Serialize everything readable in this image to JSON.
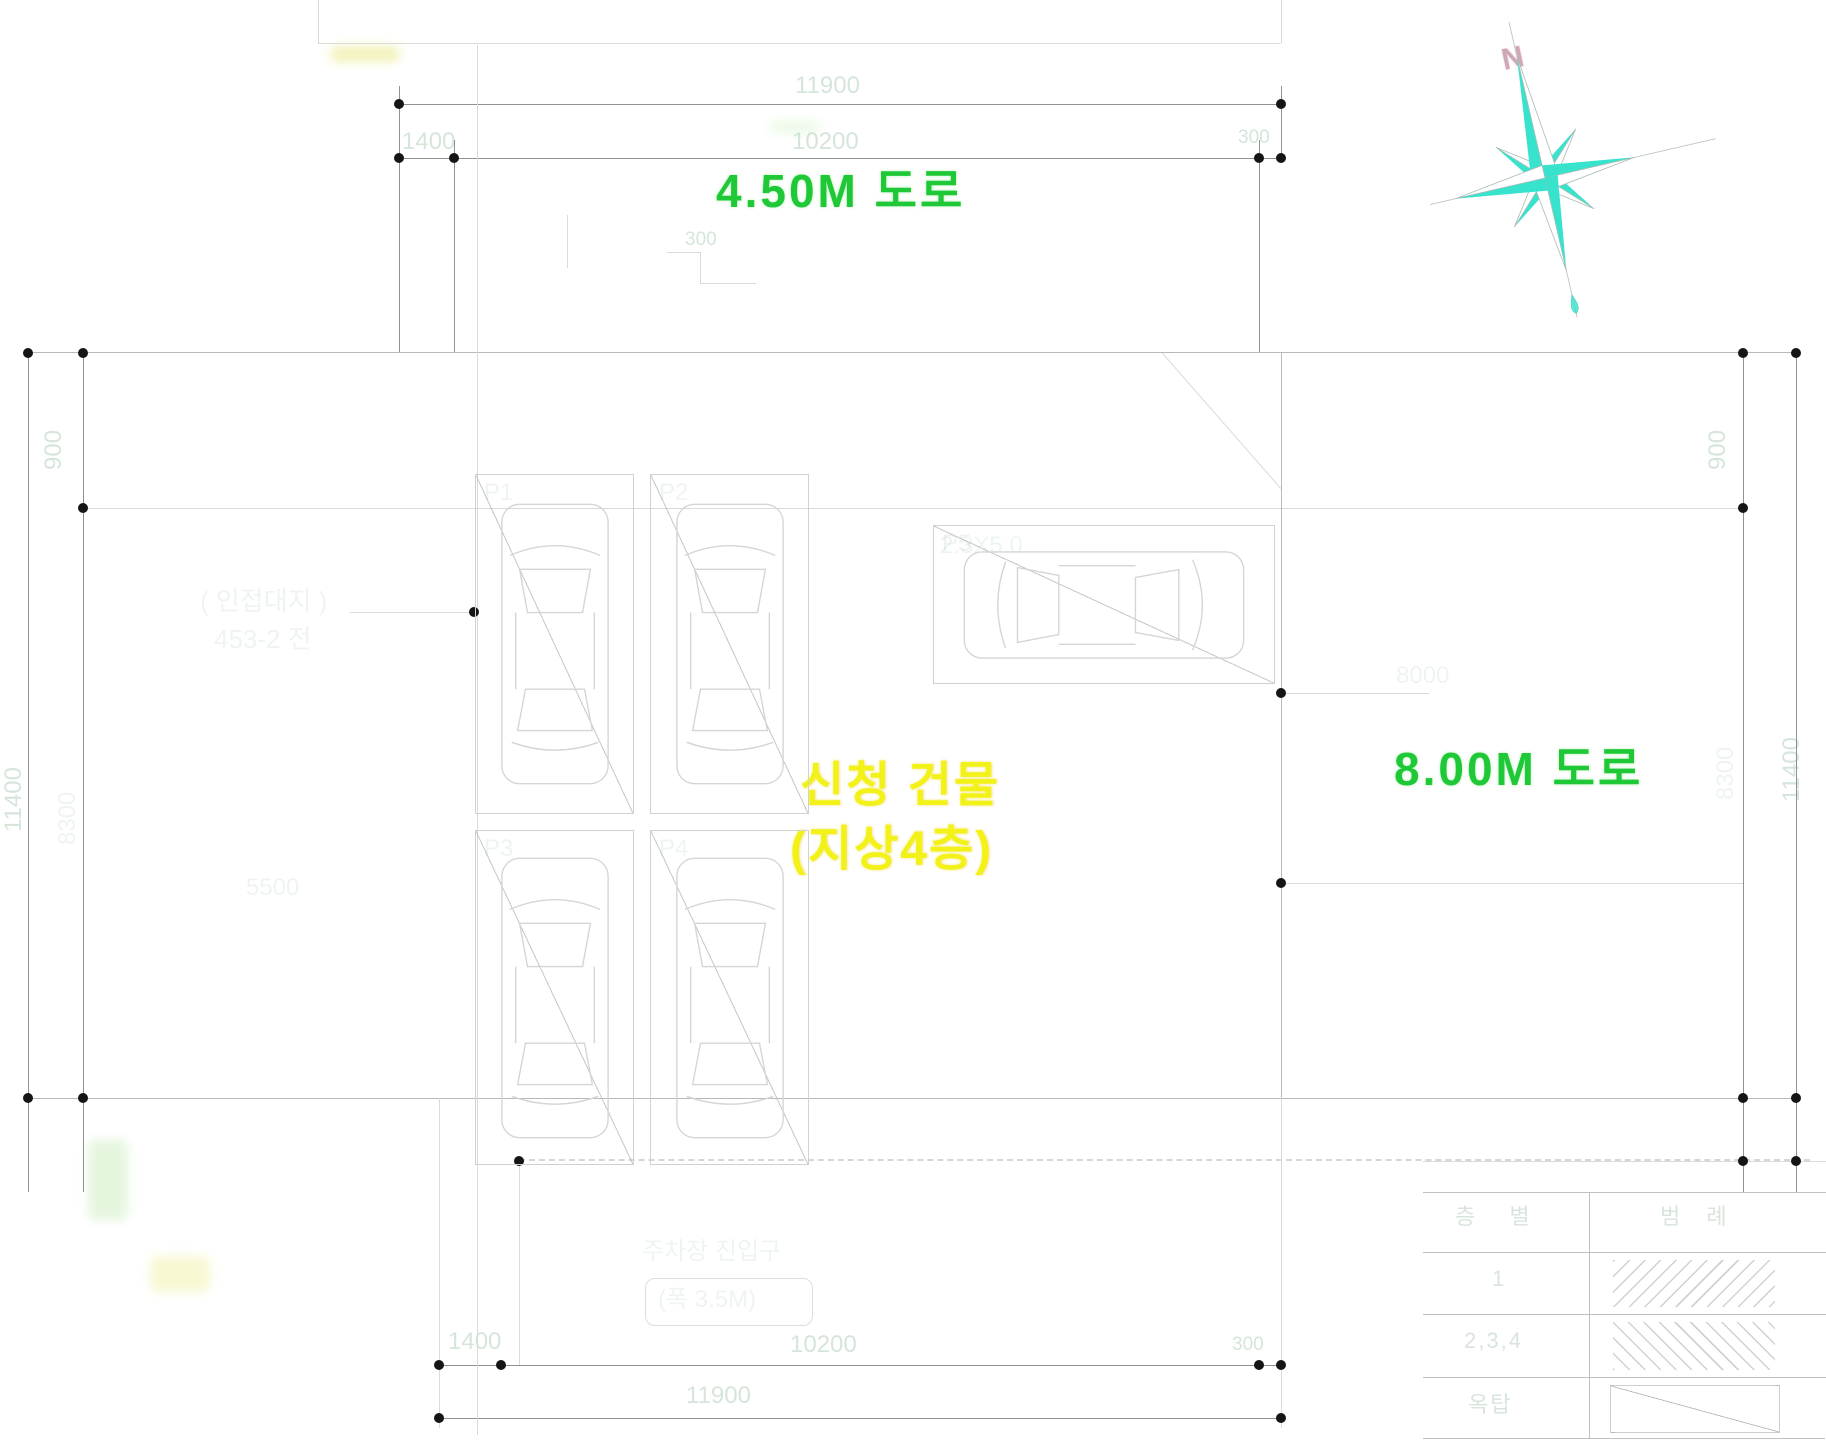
{
  "drawing": {
    "road_top_label": "4.50M 도로",
    "road_right_label": "8.00M 도로",
    "building_label_line1": "신청 건물",
    "building_label_line2": "(지상4층)",
    "north_letter": "N"
  },
  "dimensions": {
    "top_total": "11900",
    "top_left": "1400",
    "top_mid": "10200",
    "top_right": "300",
    "bottom_total": "11900",
    "bottom_left": "1400",
    "bottom_mid": "10200",
    "bottom_right": "300",
    "left_outer": "11400",
    "left_top": "900",
    "left_mid": "8300",
    "right_outer": "11400",
    "right_top": "900",
    "right_mid": "8300",
    "step": "300",
    "site_width": "5500",
    "road_right_width": "8000",
    "stall_size": "2.3X5.0"
  },
  "notes": {
    "adjacent_line1": "( 인접대지 )",
    "adjacent_line2": "453-2 전",
    "entry_line1": "주차장 진입구",
    "entry_line2": "(폭 3.5M)"
  },
  "stall_labels": [
    "P1",
    "P2",
    "P3",
    "P4",
    "P5"
  ],
  "legend_table": {
    "headers": [
      "층 별",
      "범 례"
    ],
    "rows": [
      {
        "floor": "1"
      },
      {
        "floor": "2,3,4"
      },
      {
        "floor": "옥탑"
      }
    ]
  },
  "colors": {
    "road_text_green": "#1fc837",
    "building_text_yellow": "#f2f219",
    "compass_cyan": "#38e3cd",
    "north_letter_pink": "#c79aab",
    "dim_dot_black": "#151515"
  }
}
